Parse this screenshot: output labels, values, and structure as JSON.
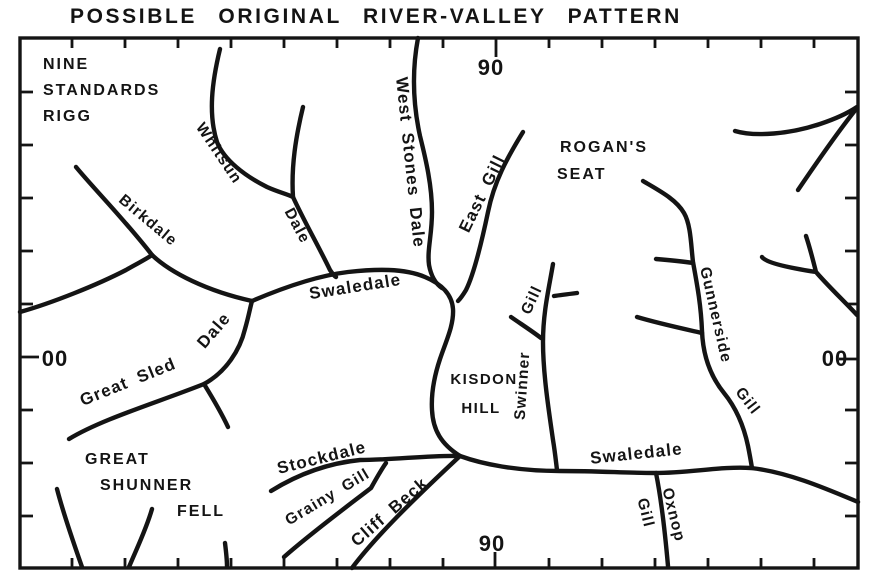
{
  "title": "POSSIBLE ORIGINAL RIVER-VALLEY PATTERN",
  "colors": {
    "ink": "#141414",
    "paper": "#ffffff"
  },
  "grid_labels": {
    "top": "90",
    "bottom": "90",
    "left": "00",
    "right": "00"
  },
  "places": {
    "nine_standards_rigg": {
      "line1": "NINE",
      "line2": "STANDARDS",
      "line3": "RIGG"
    },
    "rogans_seat": {
      "line1": "ROGAN'S",
      "line2": "SEAT"
    },
    "kisdon_hill": {
      "line1": "KISDON",
      "line2": "HILL"
    },
    "great_shunner_fell": {
      "line1": "GREAT",
      "line2": "SHUNNER",
      "line3": "FELL"
    }
  },
  "streams": {
    "birkdale": "Birkdale",
    "whitsun": "Whitsun",
    "whitsun_dale": "Dale",
    "west_stones_dale": "West Stones Dale",
    "east_gill": "East Gill",
    "swaledale_upper": "Swaledale",
    "great_sled": "Great Sled",
    "great_sled_dale": "Dale",
    "stockdale": "Stockdale",
    "grainy_gill": "Grainy Gill",
    "cliff_beck": "Cliff Beck",
    "swinner": "Swinner",
    "swinner_gill": "Gill",
    "gunnerside": "Gunnerside",
    "gunnerside_gill": "Gill",
    "swaledale_lower": "Swaledale",
    "oxnop": "Oxnop",
    "oxnop_gill": "Gill"
  }
}
